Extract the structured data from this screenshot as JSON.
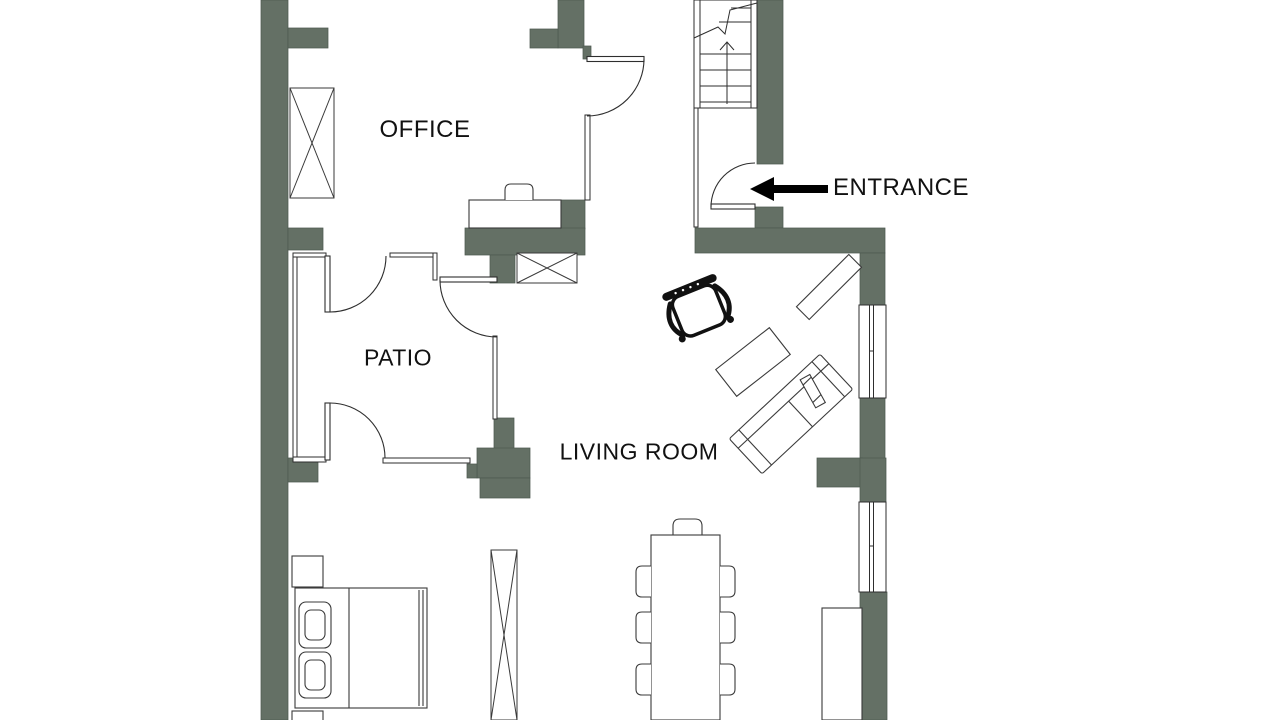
{
  "colors": {
    "background": "#ffffff",
    "wall": "#647065",
    "wall_edge": "#4d5a50",
    "line": "#2e2e2e",
    "furniture_line": "#3a3a3a",
    "text": "#111111",
    "arrow": "#000000"
  },
  "labels": {
    "office": "OFFICE",
    "patio": "PATIO",
    "living_room": "LIVING ROOM",
    "entrance": "ENTRANCE"
  }
}
